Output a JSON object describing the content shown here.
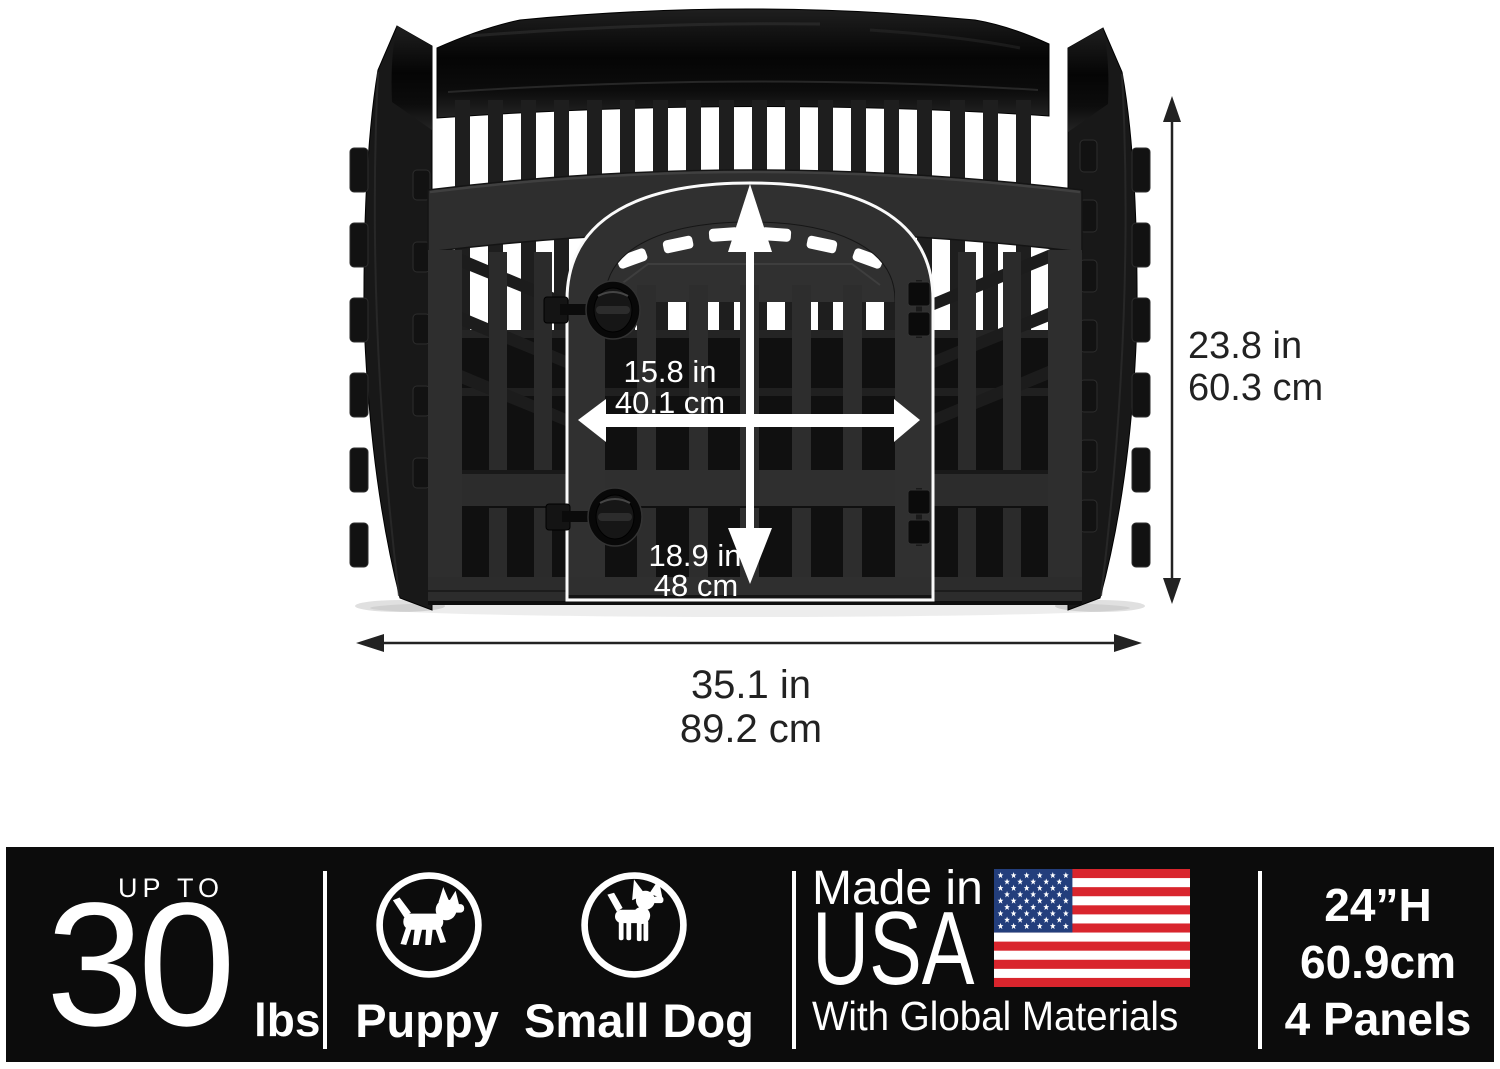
{
  "diagram": {
    "door_width": {
      "in": "15.8 in",
      "cm": "40.1 cm"
    },
    "door_height": {
      "in": "18.9 in",
      "cm": "48 cm"
    },
    "pen_height": {
      "in": "23.8 in",
      "cm": "60.3 cm"
    },
    "pen_width": {
      "in": "35.1 in",
      "cm": "89.2 cm"
    }
  },
  "banner": {
    "weight": {
      "prefix": "UP TO",
      "value": "30",
      "unit": "lbs"
    },
    "pets": [
      {
        "label": "Puppy",
        "icon": "puppy-icon"
      },
      {
        "label": "Small Dog",
        "icon": "small-dog-icon"
      }
    ],
    "origin": {
      "line1": "Made in",
      "line2": "USA",
      "line3": "With Global Materials",
      "flag_icon": "us-flag-icon"
    },
    "specs": {
      "height_in": "24”H",
      "height_cm": "60.9cm",
      "panels": "4 Panels"
    }
  },
  "colors": {
    "background": "#ffffff",
    "banner_bg": "#0c0c0c",
    "text_light": "#ffffff",
    "dimension_text": "#222222",
    "pen_color": "#2e2e2e",
    "flag_red": "#d9252d",
    "flag_white": "#ffffff",
    "flag_blue": "#233e7c"
  }
}
